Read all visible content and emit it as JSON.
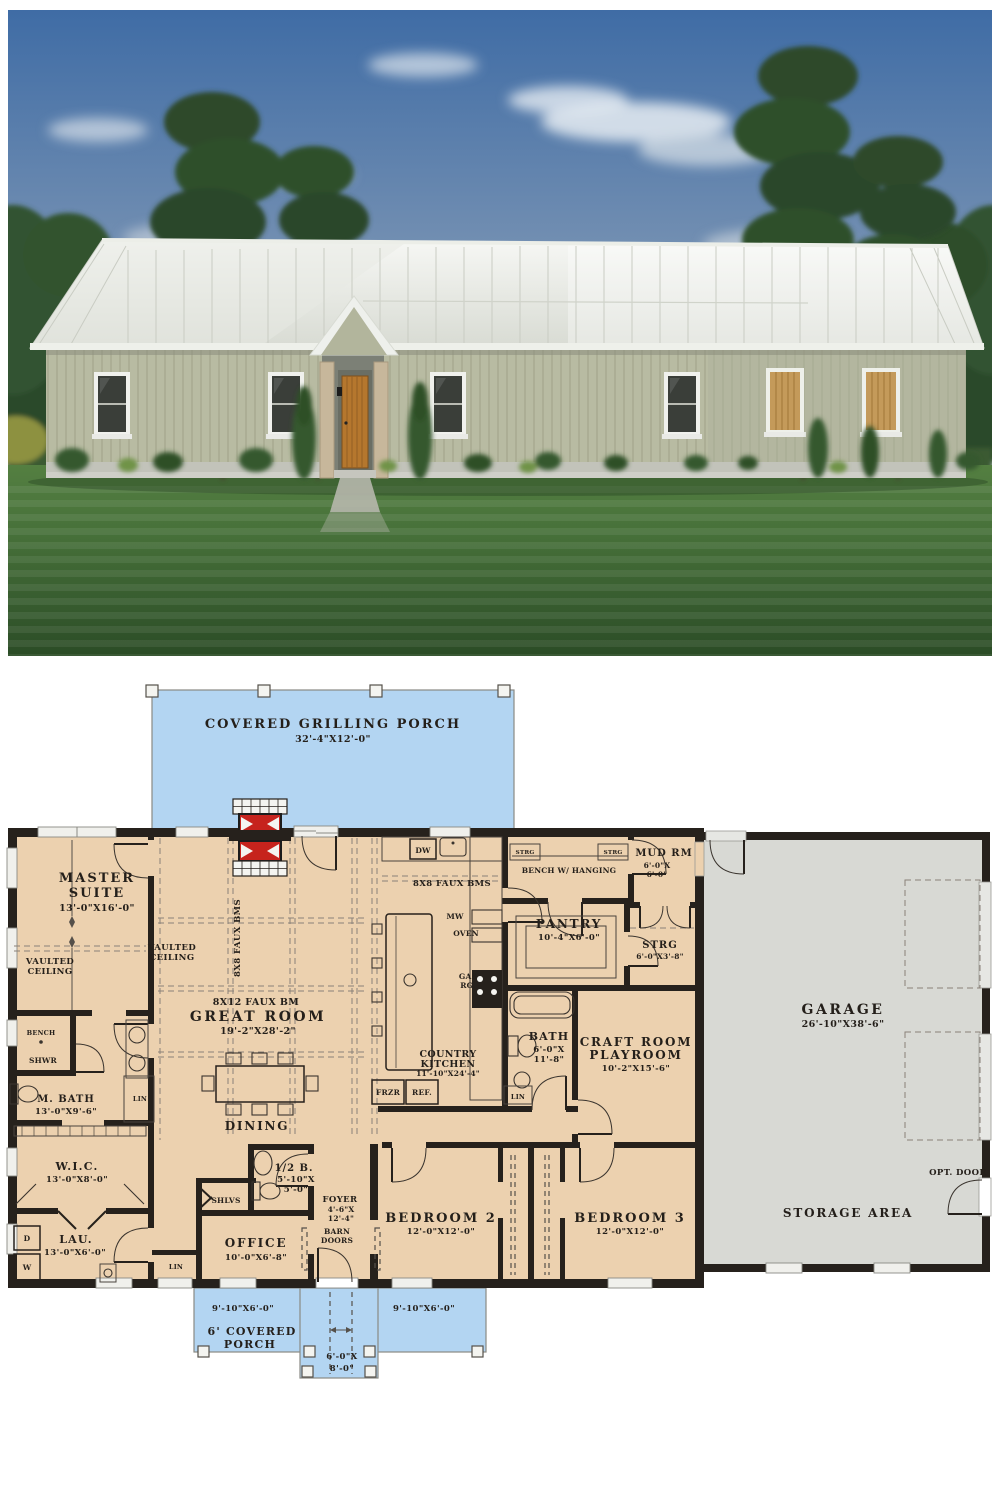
{
  "colors": {
    "plan_floor_tan": "#ecd1af",
    "porch_blue": "#b3d5f2",
    "garage_gray": "#d8d9d4",
    "wall_black": "#26211c",
    "fireplace_red": "#c6231d",
    "siding_sage": "#b8bba2",
    "roof_white": "#eceee9",
    "sky_blue": "#41699c",
    "lawn_green": "#47703a"
  },
  "plan": {
    "grilling_porch": {
      "label": "COVERED GRILLING PORCH",
      "dims": "32'-4\"X12'-0\""
    },
    "master_suite": {
      "line1": "MASTER",
      "line2": "SUITE",
      "dims": "13'-0\"X16'-0\""
    },
    "vaulted_ceiling": {
      "line1": "VAULTED",
      "line2": "CEILING"
    },
    "great_room": {
      "label": "GREAT ROOM",
      "dims": "19'-2\"X28'-2\"",
      "beams_8x8": "8X8 FAUX BMS",
      "beam_8x12": "8X12 FAUX BM"
    },
    "dining": {
      "label": "DINING"
    },
    "kitchen": {
      "line1": "COUNTRY",
      "line2": "KITCHEN",
      "dims": "11'-10\"X24'-4\"",
      "beams": "8X8 FAUX BMS",
      "dw": "DW",
      "mw": "MW",
      "oven": "OVEN",
      "gas_line1": "GAS",
      "gas_line2": "RG.",
      "frzr": "FRZR",
      "ref": "REF."
    },
    "bench_room": {
      "label": "BENCH W/ HANGING",
      "strg_left": "STRG",
      "strg_right": "STRG"
    },
    "mud_room": {
      "label": "MUD RM",
      "dims_line1": "6'-0\"X",
      "dims_line2": "6'-0\""
    },
    "pantry": {
      "label": "PANTRY",
      "dims": "10'-4\"X6'-0\""
    },
    "storage_room": {
      "label": "STRG",
      "dims": "6'-0\"X3'-8\""
    },
    "bath": {
      "label": "BATH",
      "dims_line1": "6'-0\"X",
      "dims_line2": "11'-8\"",
      "lin": "LIN"
    },
    "craft_room": {
      "line1": "CRAFT ROOM",
      "line2": "PLAYROOM",
      "dims": "10'-2\"X15'-6\""
    },
    "garage": {
      "label": "GARAGE",
      "dims": "26'-10\"X38'-6\"",
      "storage_area": "STORAGE AREA",
      "opt_door": "OPT. DOOR"
    },
    "master_bath": {
      "bench": "BENCH",
      "shower": "SHWR",
      "label": "M. BATH",
      "dims": "13'-0\"X9'-6\"",
      "lin": "LIN"
    },
    "wic": {
      "label": "W.I.C.",
      "dims": "13'-0\"X8'-0\""
    },
    "laundry": {
      "label": "LAU.",
      "dims": "13'-0\"X6'-0\"",
      "dryer": "D",
      "washer": "W"
    },
    "half_bath": {
      "label": "1/2 B.",
      "dims_line1": "5'-10\"X",
      "dims_line2": "5'-0\""
    },
    "shelves": {
      "label": "SHLVS"
    },
    "office": {
      "label": "OFFICE",
      "dims": "10'-0\"X6'-8\"",
      "lin": "LIN"
    },
    "foyer": {
      "label": "FOYER",
      "dims_line1": "4'-6\"X",
      "dims_line2": "12'-4\"",
      "barn_line1": "BARN",
      "barn_line2": "DOORS"
    },
    "bedroom2": {
      "label": "BEDROOM 2",
      "dims": "12'-0\"X12'-0\""
    },
    "bedroom3": {
      "label": "BEDROOM 3",
      "dims": "12'-0\"X12'-0\""
    },
    "front_porch": {
      "left_dims": "9'-10\"X6'-0\"",
      "right_dims": "9'-10\"X6'-0\"",
      "line1": "6' COVERED",
      "line2": "PORCH",
      "stoop_dims_line1": "6'-0\"X",
      "stoop_dims_line2": "8'-0\""
    }
  }
}
